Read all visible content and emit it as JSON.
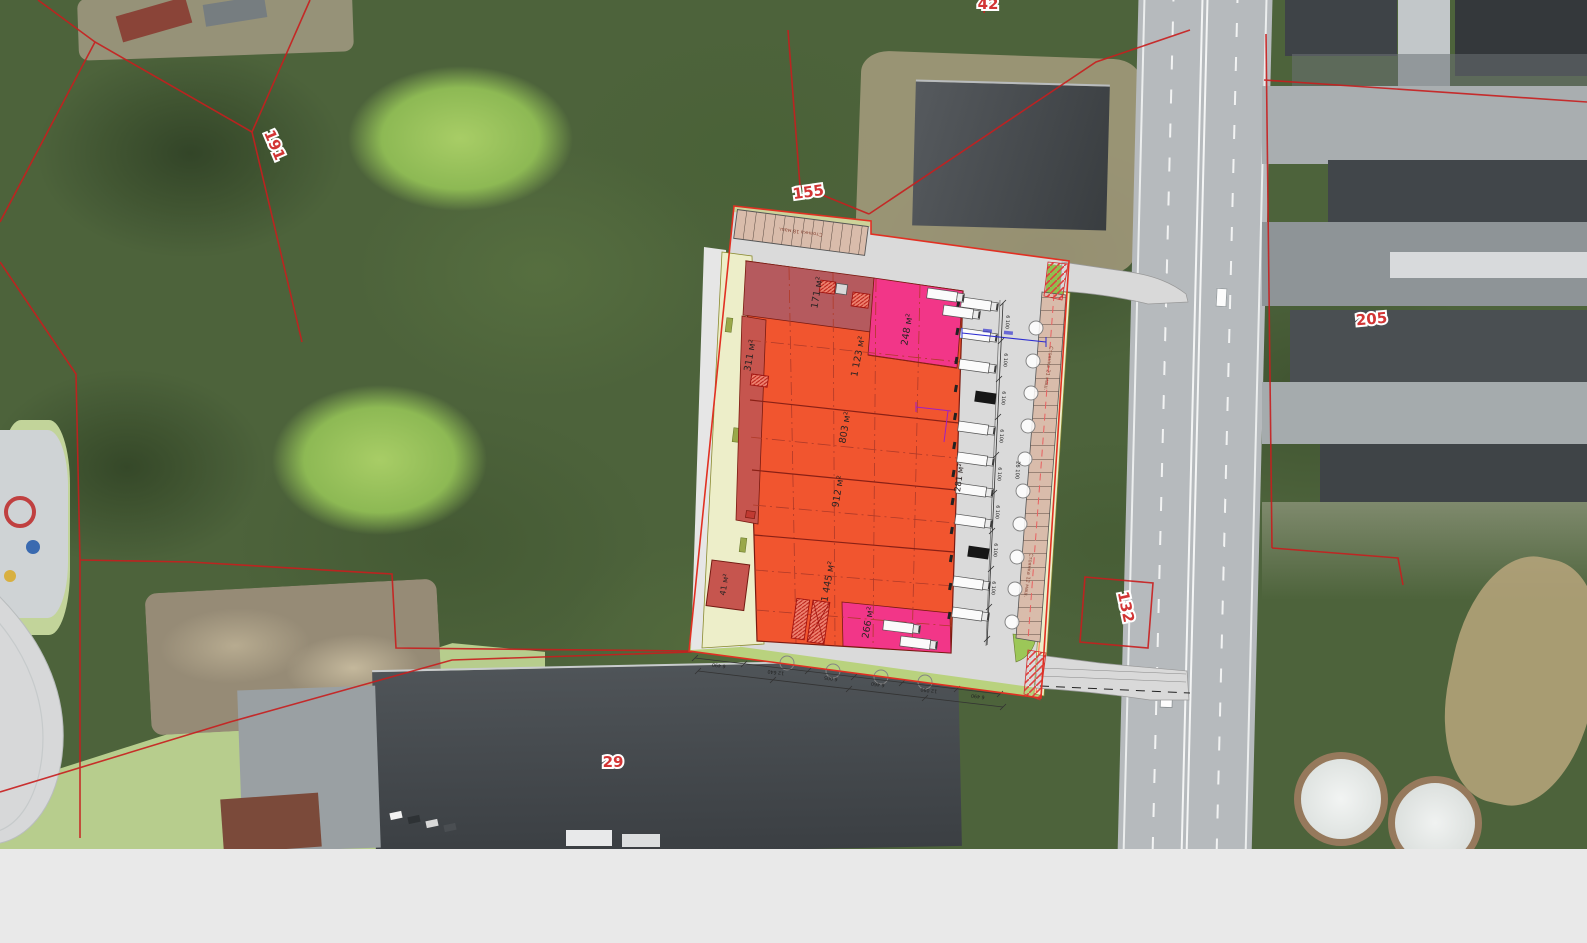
{
  "map_title": "Aerial site plan overlay",
  "parcels": {
    "p42": "42",
    "p191": "191",
    "p155": "155",
    "p205": "205",
    "p132": "132",
    "p29": "29"
  },
  "site_plan": {
    "areas": {
      "a171": "171 м²",
      "a248": "248 м²",
      "a1123": "1 123 м²",
      "a311": "311 м²",
      "a803": "803 м²",
      "a912": "912 м²",
      "a281": "281 м²",
      "a1445": "1 445 м²",
      "a41": "41 м²",
      "a266": "266 м²"
    },
    "parking": {
      "top": "Стоянка 18 маш.",
      "right_upper": "Стоянка 21 маш.",
      "right_lower": "Стоянка 12 маш."
    },
    "dimensions": {
      "dock_step": "6 100",
      "dock_total": "26 100",
      "bottom": [
        "6 490",
        "12 640",
        "6 005",
        "6 460",
        "12 090",
        "6 490"
      ]
    }
  },
  "colors": {
    "cadastral_line": "#c81e1e",
    "plan_boundary": "#e13022",
    "building_orange": "#f1552f",
    "building_dark_red": "#c6554e",
    "building_pink": "#f23688",
    "plan_road_gray": "#dadada",
    "landscape_yellow": "#edeec9",
    "grass_green": "#9cc758",
    "parking_tan": "#d9bcab",
    "dim_blue": "#2b2bd0",
    "dim_purple": "#a020c0"
  }
}
